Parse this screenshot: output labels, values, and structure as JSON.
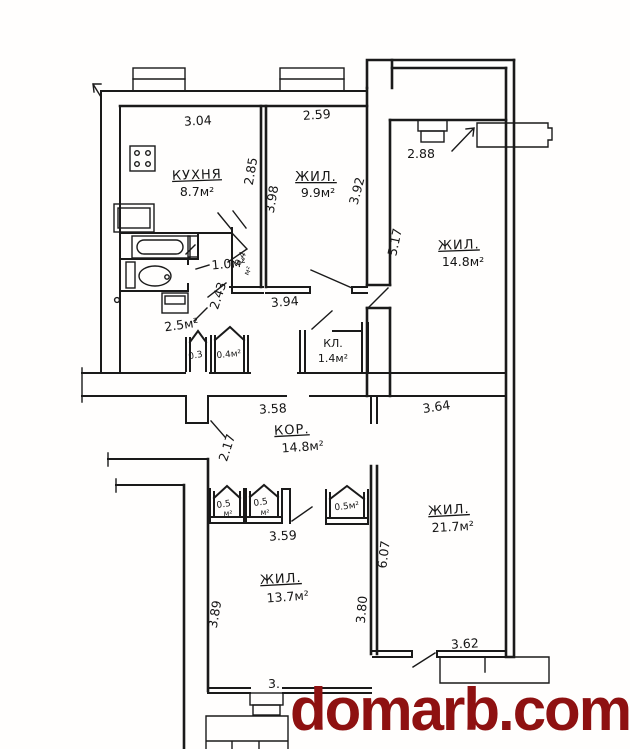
{
  "plan_title": "apartment floor plan",
  "watermark": {
    "text": "domarb.com",
    "color": "#8e1111"
  },
  "ink_color": "#1a1a1a",
  "rooms": {
    "kitchen": {
      "name": "КУХНЯ",
      "area": "8.7м²"
    },
    "living_top": {
      "name": "ЖИЛ.",
      "area": "9.9м²"
    },
    "living_right": {
      "name": "ЖИЛ.",
      "area": "14.8м²"
    },
    "corridor": {
      "name": "КОР.",
      "area": "14.8м²"
    },
    "living_bottom_left": {
      "name": "ЖИЛ.",
      "area": "13.7м²"
    },
    "living_bottom_right": {
      "name": "ЖИЛ.",
      "area": "21.7м²"
    },
    "pantry": {
      "name": "КЛ.",
      "area": "1.4м²"
    },
    "wc": {
      "area": "1.0м²"
    },
    "bath": {
      "area": "2.5м²"
    },
    "store_03": {
      "area": "0.3"
    },
    "store_04_row": {
      "area": "0.4м²"
    },
    "store_04_mid": {
      "area_line1": "0.4",
      "area_line2": "м²"
    },
    "builtin_05a": {
      "area_line1": "0.5",
      "area_line2": "м²"
    },
    "builtin_05b": {
      "area_line1": "0.5",
      "area_line2": "м²"
    },
    "builtin_05c": {
      "area": "0.5м²"
    }
  },
  "dimensions": {
    "kitchen_width": "3.04",
    "kitchen_depth": "2.85",
    "living_top_width": "2.59",
    "living_top_left": "3.98",
    "living_top_right": "3.92",
    "living_right_top": "2.88",
    "living_right_side": "5.17",
    "hall_depth": "2.43",
    "hall_width": "3.94",
    "corridor_left": "3.58",
    "corridor_right": "3.64",
    "entry_width": "2.17",
    "closet_row_width": "3.59",
    "living_bl_side": "3.89",
    "living_bl_bottom_partial": "3.",
    "living_br_left": "3.80",
    "living_br_side": "6.07",
    "living_br_bottom": "3.62"
  }
}
